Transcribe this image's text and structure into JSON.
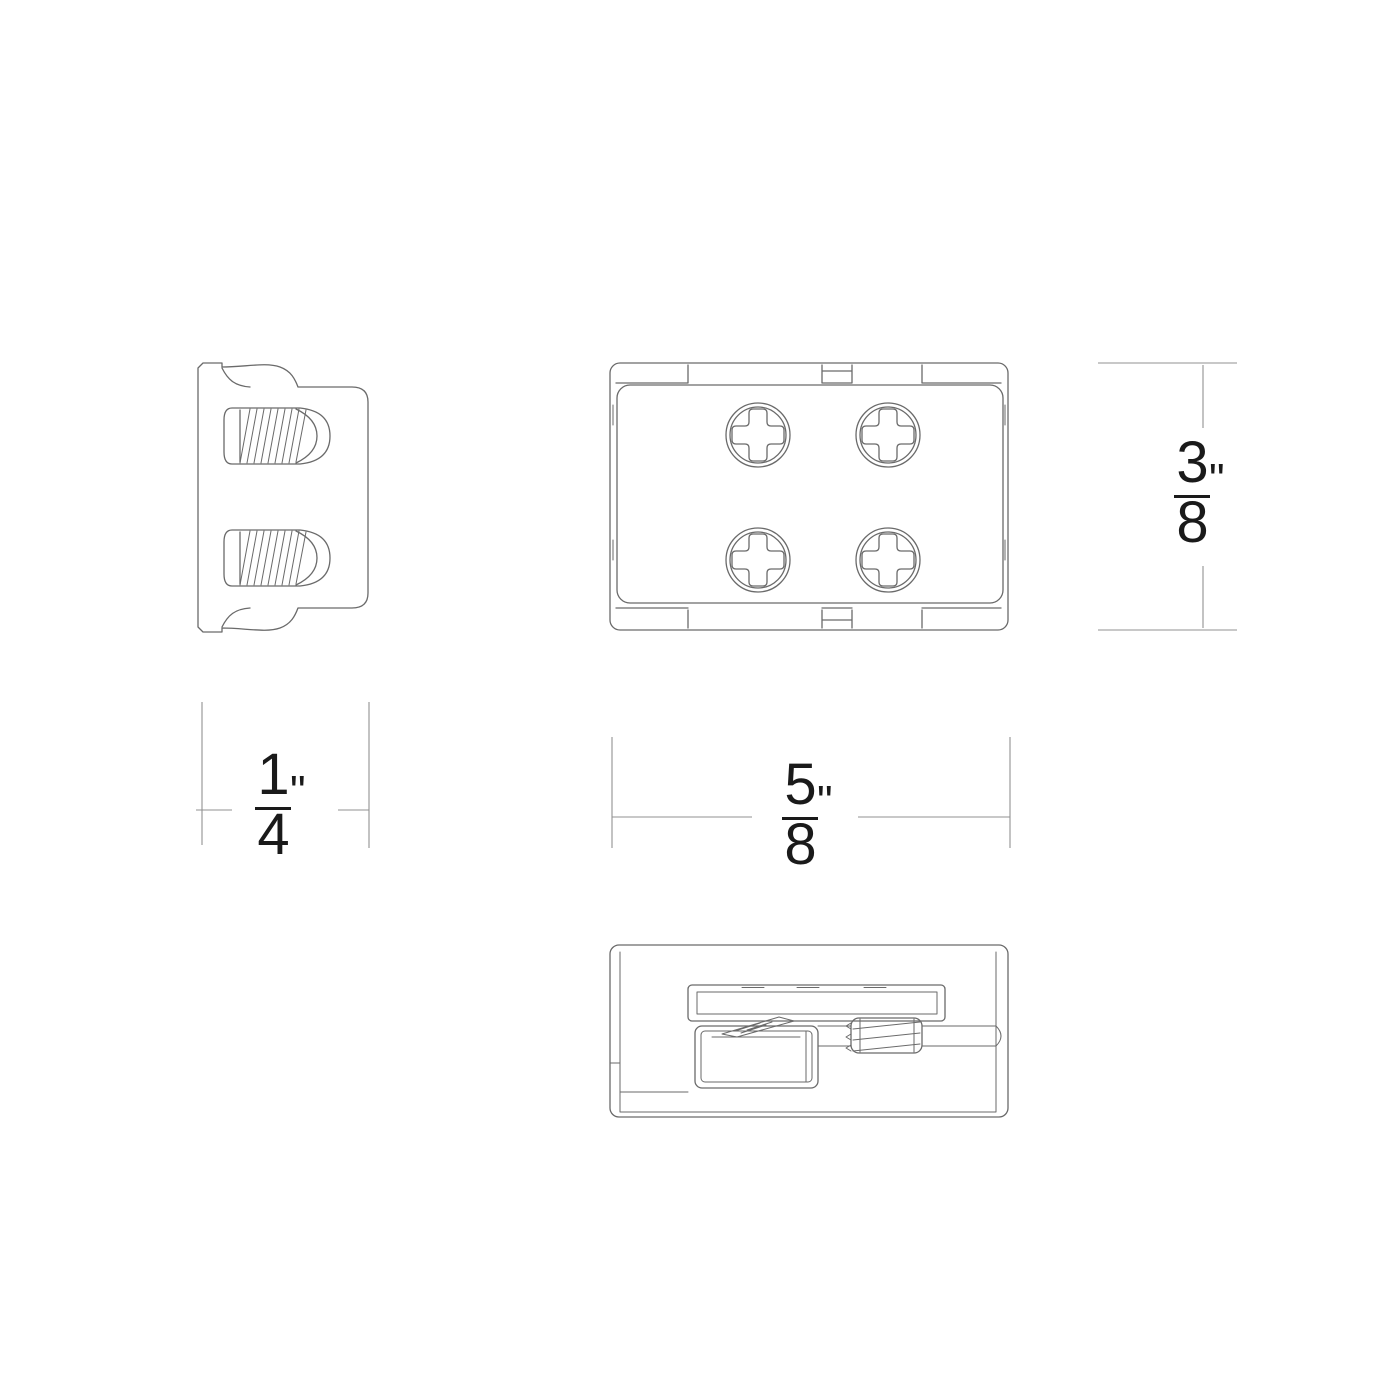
{
  "drawing": {
    "type": "technical-dimension-drawing",
    "background_color": "#ffffff",
    "part_line_color": "#6a6a6a",
    "dim_line_color": "#929292",
    "text_color": "#1a1a1a",
    "views": [
      {
        "id": "end-view",
        "description": "end view with mounting flange and two threaded screws"
      },
      {
        "id": "top-view",
        "description": "top view with four phillips screws and edge tabs"
      },
      {
        "id": "side-view",
        "description": "side section view with strip channel, terminal box and set screw"
      }
    ],
    "dimensions": {
      "height": {
        "numerator": "3",
        "denominator": "8",
        "unit": "\""
      },
      "depth": {
        "numerator": "1",
        "denominator": "4",
        "unit": "\""
      },
      "width": {
        "numerator": "5",
        "denominator": "8",
        "unit": "\""
      }
    }
  }
}
